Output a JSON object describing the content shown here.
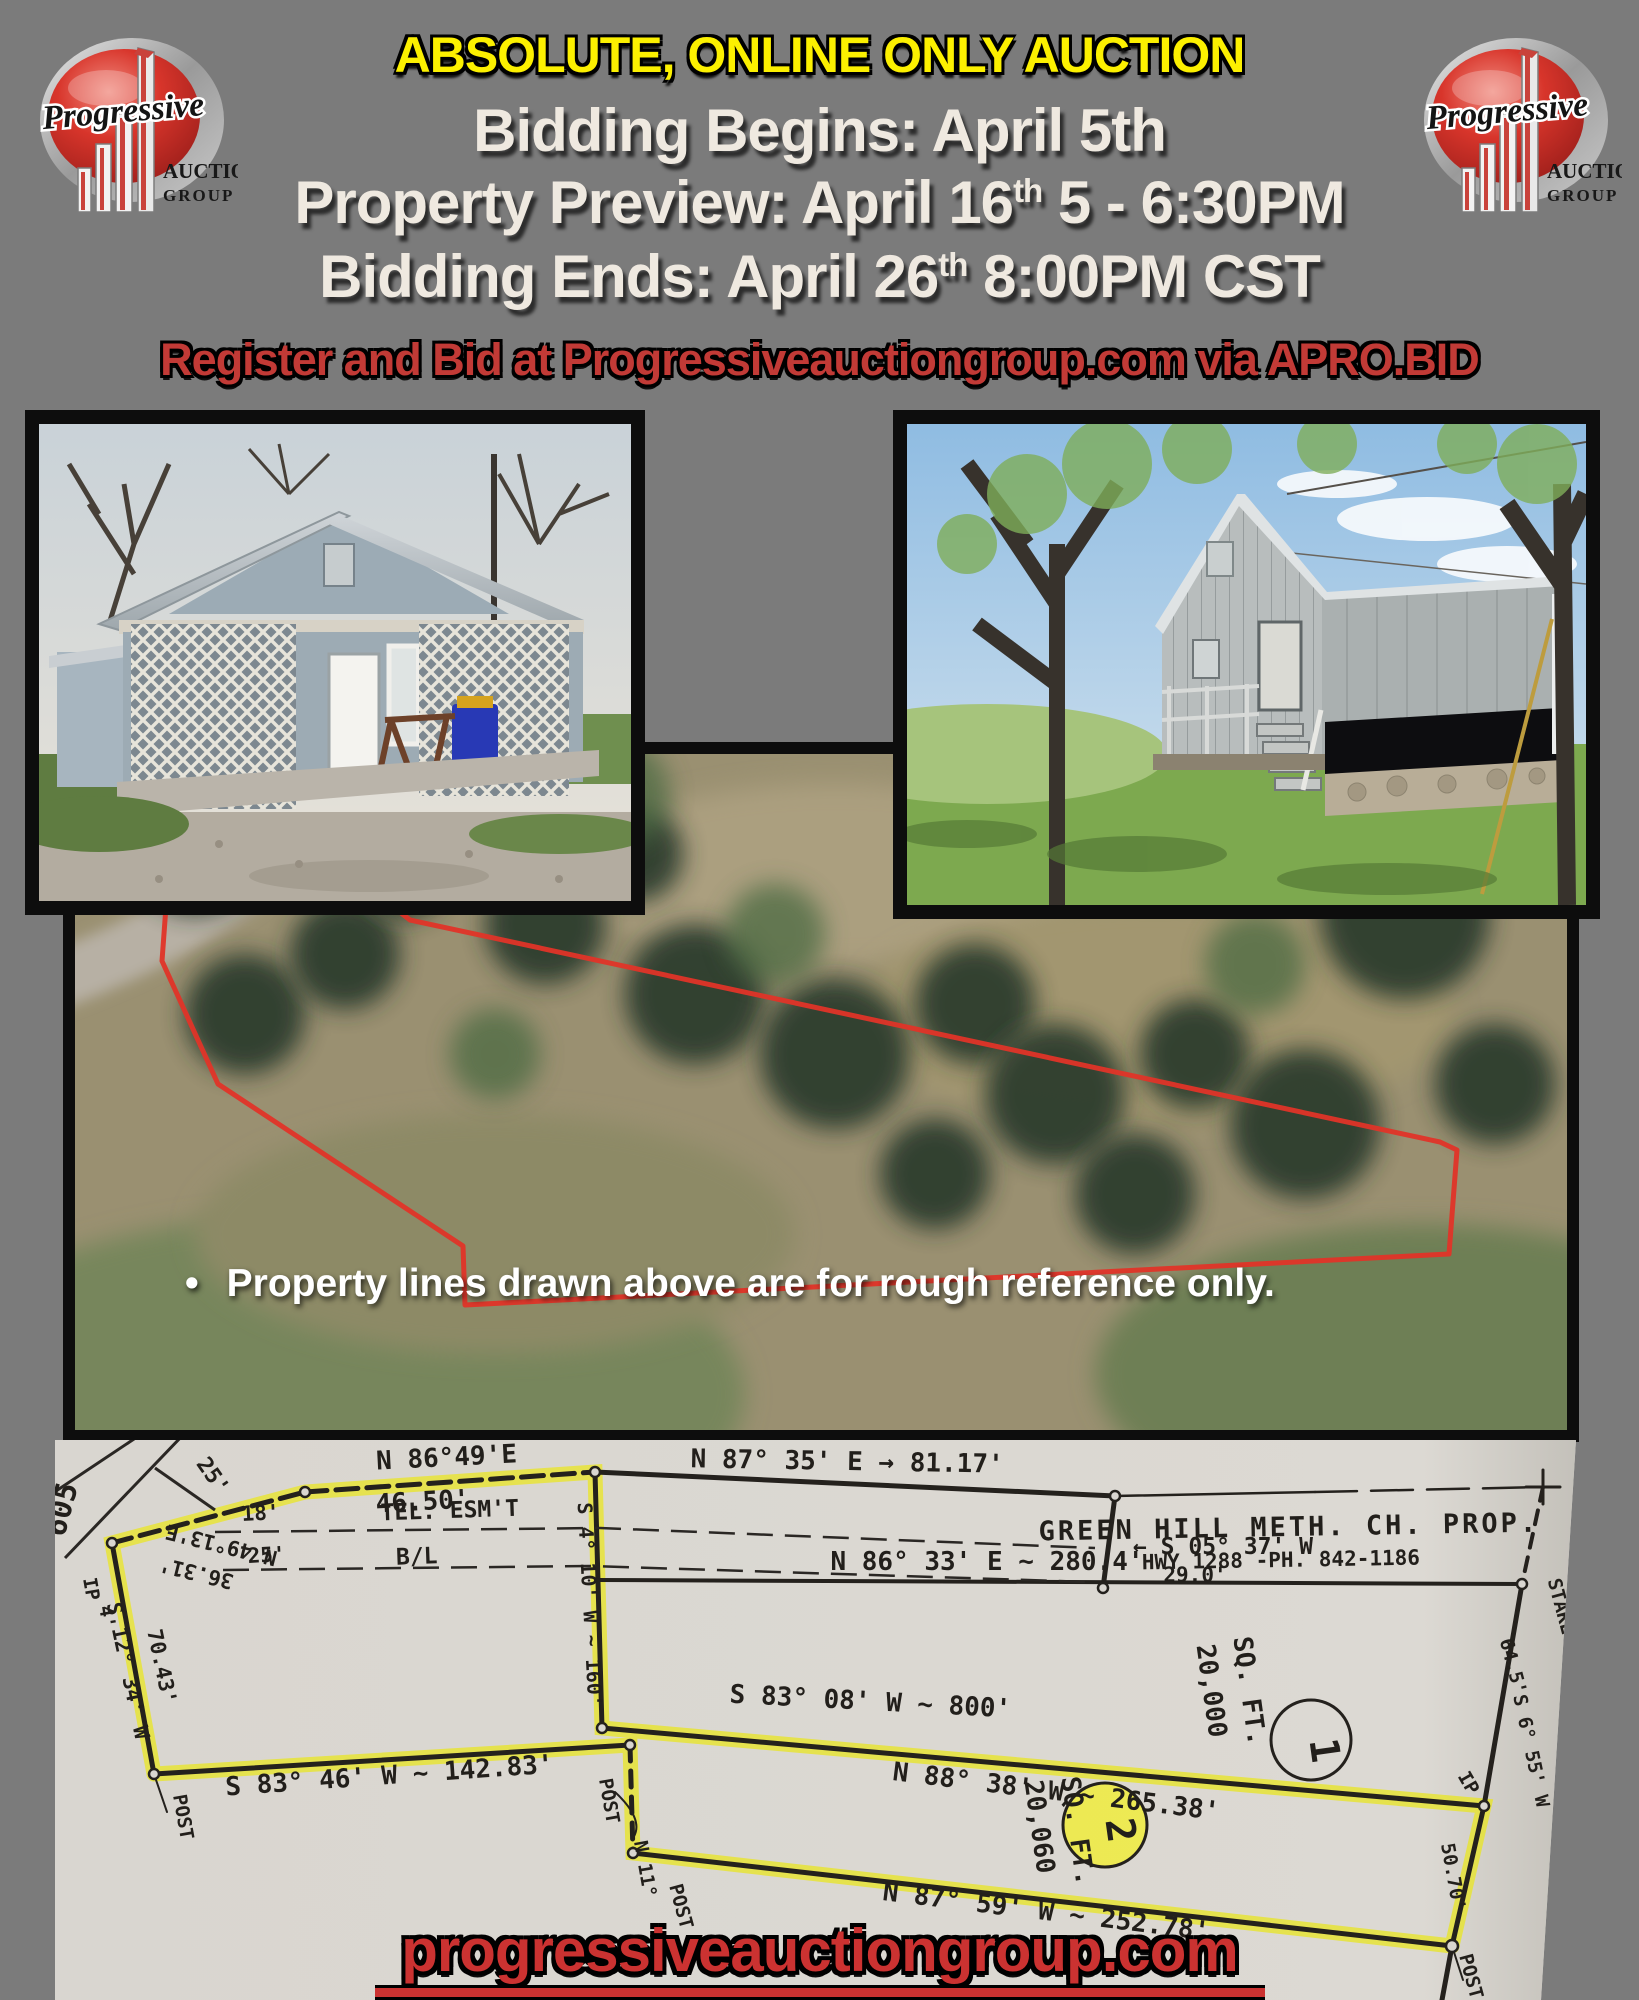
{
  "colors": {
    "background": "#7b7b7b",
    "banner_yellow": "#fcf000",
    "cream": "#efe9e0",
    "red_text": "#c23a36",
    "footer_red": "#cb3231",
    "paper": "#d9d6d0",
    "highlighter": "#e8e52e",
    "property_line_red": "#e03428",
    "photo_border": "#0d0d0d"
  },
  "header": {
    "banner": "ABSOLUTE, ONLINE ONLY AUCTION",
    "schedule": [
      {
        "pre": "Bidding Begins: April 5th",
        "sup": "",
        "post": ""
      },
      {
        "pre": "Property Preview: April 16",
        "sup": "th",
        "post": " 5 - 6:30PM"
      },
      {
        "pre": "Bidding Ends: April 26",
        "sup": "th",
        "post": " 8:00PM CST"
      }
    ],
    "register_line": "Register and Bid at  Progressiveauctiongroup.com via APRO.BID"
  },
  "logo": {
    "brand": "Progressive",
    "word1": "AUCTION",
    "word2": "GROUP"
  },
  "aerial": {
    "bullet": "•",
    "note": "Property lines drawn above are for rough reference only."
  },
  "footer": {
    "website": "progressiveauctiongroup.com"
  },
  "plat": {
    "title": "GREEN HILL METH. CH. PROP.",
    "lot1": {
      "number": "1",
      "area": "20,000 SQ. FT."
    },
    "lot2": {
      "number": "2",
      "area": "20,060 SQ. FT."
    },
    "labels": [
      {
        "text": "605",
        "x": 16,
        "y": 72,
        "r": -75,
        "s": 30
      },
      {
        "text": "25'",
        "x": 152,
        "y": 40,
        "r": 55,
        "s": 22
      },
      {
        "text": "N 49°13'E",
        "x": 168,
        "y": 98,
        "r": 194,
        "s": 21
      },
      {
        "text": "36.31'",
        "x": 143,
        "y": 126,
        "r": 194,
        "s": 21
      },
      {
        "text": "IP",
        "x": 30,
        "y": 150,
        "r": 80,
        "s": 19
      },
      {
        "text": "4'",
        "x": 46,
        "y": 178,
        "r": 80,
        "s": 19
      },
      {
        "text": "S 12° 34' W",
        "x": 66,
        "y": 232,
        "r": 78,
        "s": 21
      },
      {
        "text": "70.43'",
        "x": 100,
        "y": 228,
        "r": 78,
        "s": 21
      },
      {
        "text": "POST",
        "x": 122,
        "y": 378,
        "r": 80,
        "s": 19
      },
      {
        "text": "S 83° 46' W ~ 142.83'",
        "x": 335,
        "y": 344,
        "r": -4,
        "s": 26
      },
      {
        "text": "N 86°49'E",
        "x": 392,
        "y": 26,
        "r": -3,
        "s": 26
      },
      {
        "text": "46.50'",
        "x": 368,
        "y": 70,
        "r": -3,
        "s": 26
      },
      {
        "text": "18'",
        "x": 206,
        "y": 80,
        "r": -3,
        "s": 21
      },
      {
        "text": "TEL. ESM'T",
        "x": 395,
        "y": 78,
        "r": -2,
        "s": 23
      },
      {
        "text": "25'",
        "x": 212,
        "y": 122,
        "r": -3,
        "s": 21
      },
      {
        "text": "B/L",
        "x": 362,
        "y": 124,
        "r": -2,
        "s": 23
      },
      {
        "text": "N 87° 35' E → 81.17'",
        "x": 792,
        "y": 30,
        "r": 1,
        "s": 26
      },
      {
        "text": "← S 05° 37' W",
        "x": 1168,
        "y": 114,
        "r": 0,
        "s": 23
      },
      {
        "text": "29.0'",
        "x": 1140,
        "y": 142,
        "r": 0,
        "s": 21
      },
      {
        "text": "GREEN HILL METH. CH. PROP.",
        "x": 1234,
        "y": 96,
        "r": -1,
        "s": 27,
        "ls": 3
      },
      {
        "text": "HWY 1288 -PH. 842-1186",
        "x": 1226,
        "y": 127,
        "r": -1,
        "s": 21
      },
      {
        "text": "N 86° 33' E ~ 280.4'",
        "x": 932,
        "y": 130,
        "r": 0,
        "s": 26
      },
      {
        "text": "20,000",
        "x": 1148,
        "y": 252,
        "r": 82,
        "s": 26
      },
      {
        "text": "SQ. FT.",
        "x": 1186,
        "y": 252,
        "r": 82,
        "s": 26
      },
      {
        "text": "1",
        "x": 1256,
        "y": 312,
        "r": 82,
        "s": 40
      },
      {
        "text": "STAKE",
        "x": 1500,
        "y": 168,
        "r": 75,
        "s": 19
      },
      {
        "text": "64.5'",
        "x": 1452,
        "y": 228,
        "r": 75,
        "s": 19
      },
      {
        "text": "S 6° 55' W",
        "x": 1470,
        "y": 312,
        "r": 78,
        "s": 19
      },
      {
        "text": "IP",
        "x": 1408,
        "y": 346,
        "r": 60,
        "s": 19
      },
      {
        "text": "50.70'",
        "x": 1392,
        "y": 438,
        "r": 80,
        "s": 19
      },
      {
        "text": "POST",
        "x": 1410,
        "y": 538,
        "r": 75,
        "s": 19
      },
      {
        "text": "S 83° 08' W ~ 800'",
        "x": 815,
        "y": 270,
        "r": 3,
        "s": 26
      },
      {
        "text": "N 88° 38' W ~ 265.38'",
        "x": 1000,
        "y": 360,
        "r": 7,
        "s": 26
      },
      {
        "text": "20,060",
        "x": 976,
        "y": 388,
        "r": 82,
        "s": 26
      },
      {
        "text": "SQ. FT.",
        "x": 1014,
        "y": 392,
        "r": 82,
        "s": 26
      },
      {
        "text": "2",
        "x": 1052,
        "y": 392,
        "r": 82,
        "s": 40
      },
      {
        "text": "N 87° 59' W ~ 252.78'",
        "x": 990,
        "y": 480,
        "r": 7,
        "s": 26
      },
      {
        "text": "POST",
        "x": 548,
        "y": 362,
        "r": 80,
        "s": 19
      },
      {
        "text": "N 11°",
        "x": 584,
        "y": 430,
        "r": 80,
        "s": 19
      },
      {
        "text": "POST",
        "x": 620,
        "y": 468,
        "r": 75,
        "s": 19
      },
      {
        "text": "S 4° 10' W ~ 160'",
        "x": 528,
        "y": 165,
        "r": 87,
        "s": 20
      }
    ]
  }
}
